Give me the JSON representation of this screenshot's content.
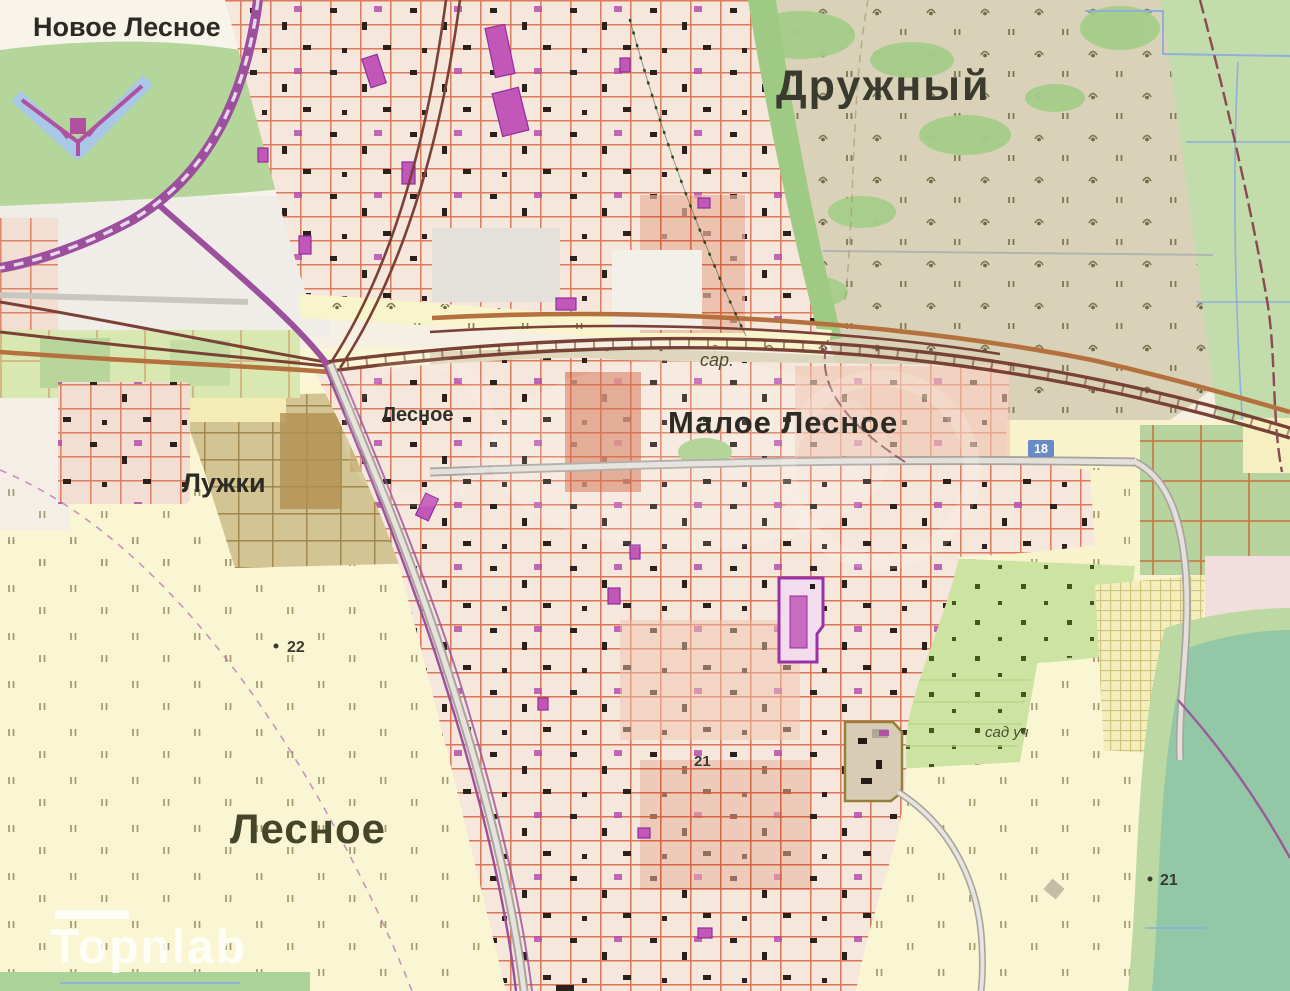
{
  "map": {
    "type": "topographic-map",
    "labels": {
      "novoe_lesnoe": {
        "text": "Новое Лесное"
      },
      "druzhny": {
        "text": "Дружный"
      },
      "luzhki": {
        "text": "Лужки"
      },
      "lesnoe_small": {
        "text": "Лесное"
      },
      "maloe_lesnoe": {
        "text": "Малое Лесное"
      },
      "lesnoe_big": {
        "text": "Лесное"
      },
      "sar": {
        "text": "сар."
      },
      "sad_uch": {
        "text": "сад уч"
      },
      "marker_22": {
        "text": "22"
      },
      "marker_21_a": {
        "text": "21"
      },
      "marker_21_b": {
        "text": "21"
      },
      "km_18": {
        "text": "18"
      },
      "watermark": {
        "text": "Topnlab"
      }
    },
    "colors": {
      "field_yellow": "#faf6d4",
      "scrub_tan": "#d9d2b8",
      "park_green": "#b4d69a",
      "orchard_green": "#cde3a2",
      "pond_green": "#93c8a6",
      "urban_base": "#f6e7dc",
      "parcel_red": "#d25a36",
      "building_black": "#2b211c",
      "building_magenta": "#c257b8",
      "railway_brown": "#7a4136",
      "motorway_purple": "#9b4f9c",
      "road_orange": "#b5713d",
      "road_gray": "#d6d2cc",
      "moat_blue": "#a9c7e6",
      "allotment_brown": "#d3c494",
      "water_line_blue": "#8fb0d8",
      "label_dark": "#2b2b24",
      "km_post_blue": "#5b82c8"
    }
  }
}
